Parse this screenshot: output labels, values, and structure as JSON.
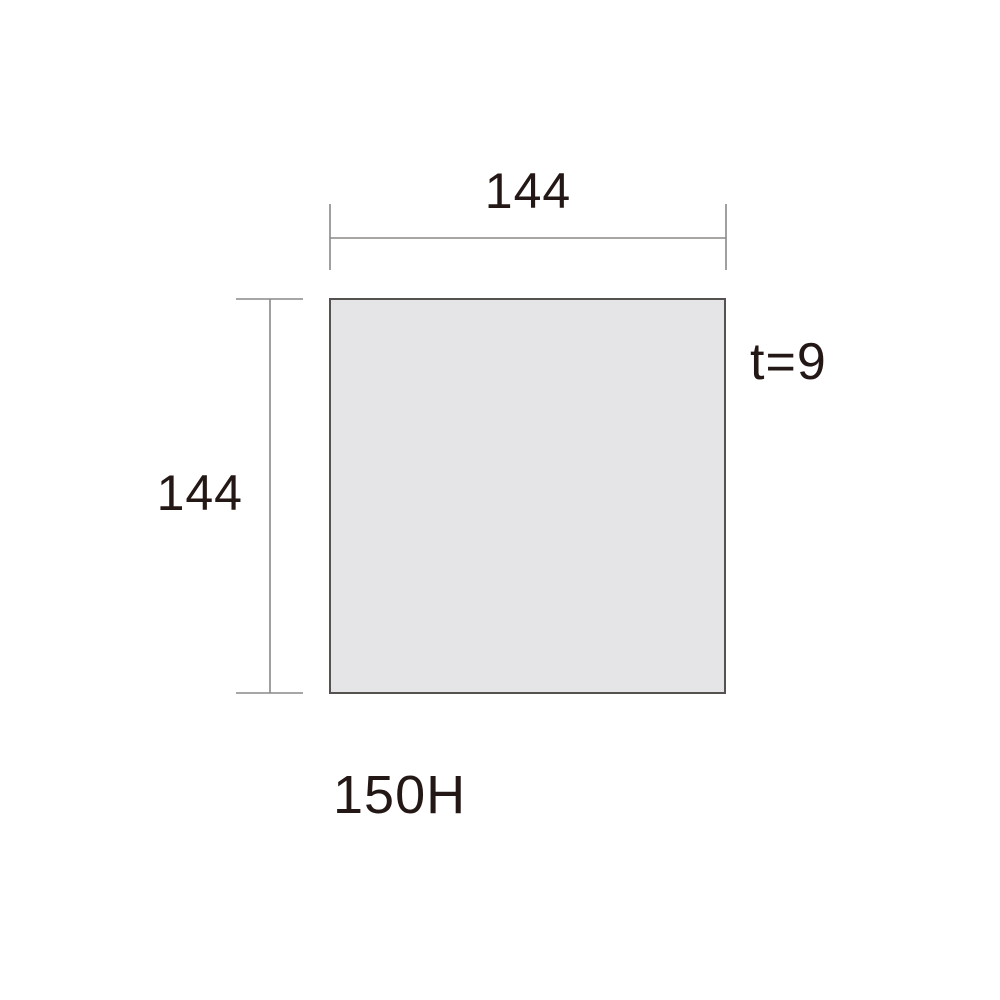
{
  "diagram": {
    "model_label": "150H",
    "thickness_label": "t=9",
    "width_dimension": {
      "label": "144"
    },
    "height_dimension": {
      "label": "144"
    }
  },
  "colors": {
    "text": "#231815",
    "dimension_line": "#8a8886",
    "plate_fill": "#e5e4e6",
    "plate_border": "#565250",
    "background": "#ffffff"
  }
}
